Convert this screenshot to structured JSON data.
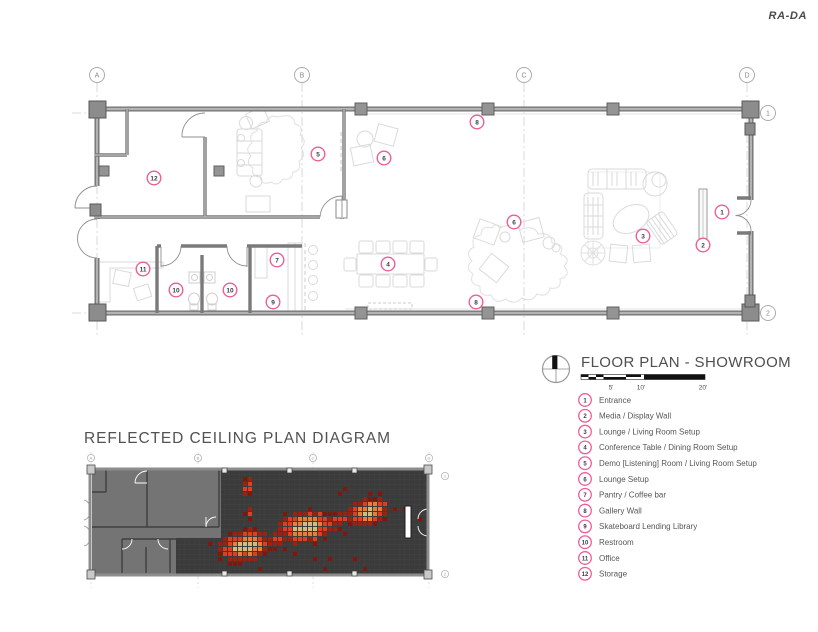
{
  "brand": {
    "logo": "RA-DA"
  },
  "floor_plan": {
    "title": "FLOOR PLAN - SHOWROOM",
    "scale_labels": [
      {
        "text": "5'",
        "x": 611
      },
      {
        "text": "10'",
        "x": 641
      },
      {
        "text": "20'",
        "x": 703
      }
    ],
    "grid_columns": [
      {
        "label": "A",
        "x": 97
      },
      {
        "label": "B",
        "x": 302
      },
      {
        "label": "C",
        "x": 524
      },
      {
        "label": "D",
        "x": 747
      }
    ],
    "grid_rows": [
      {
        "label": "1",
        "y": 113
      },
      {
        "label": "2",
        "y": 313
      }
    ],
    "markers": [
      {
        "num": "1",
        "x": 722,
        "y": 212
      },
      {
        "num": "2",
        "x": 703,
        "y": 245
      },
      {
        "num": "3",
        "x": 643,
        "y": 236
      },
      {
        "num": "4",
        "x": 388,
        "y": 264
      },
      {
        "num": "5",
        "x": 318,
        "y": 154
      },
      {
        "num": "6",
        "x": 384,
        "y": 158
      },
      {
        "num": "6",
        "x": 514,
        "y": 222
      },
      {
        "num": "7",
        "x": 277,
        "y": 260
      },
      {
        "num": "8",
        "x": 477,
        "y": 122
      },
      {
        "num": "8",
        "x": 476,
        "y": 302
      },
      {
        "num": "9",
        "x": 273,
        "y": 302
      },
      {
        "num": "10",
        "x": 176,
        "y": 290
      },
      {
        "num": "10",
        "x": 230,
        "y": 290
      },
      {
        "num": "11",
        "x": 143,
        "y": 269
      },
      {
        "num": "12",
        "x": 154,
        "y": 178
      }
    ],
    "legend": {
      "items": [
        {
          "num": "1",
          "label": "Entrance"
        },
        {
          "num": "2",
          "label": "Media / Display Wall"
        },
        {
          "num": "3",
          "label": "Lounge / Living Room Setup"
        },
        {
          "num": "4",
          "label": "Conference Table / Dining Room Setup"
        },
        {
          "num": "5",
          "label": "Demo [Listening] Room / Living Room Setup"
        },
        {
          "num": "6",
          "label": "Lounge Setup"
        },
        {
          "num": "7",
          "label": "Pantry / Coffee bar"
        },
        {
          "num": "8",
          "label": "Gallery Wall"
        },
        {
          "num": "9",
          "label": "Skateboard Lending Library"
        },
        {
          "num": "10",
          "label": "Restroom"
        },
        {
          "num": "11",
          "label": "Office"
        },
        {
          "num": "12",
          "label": "Storage"
        }
      ]
    },
    "marker_color": "#ee5e95"
  },
  "ceiling_plan": {
    "title": "REFLECTED CEILING PLAN DIAGRAM",
    "grid_columns": [
      {
        "label": "A",
        "x": 91
      },
      {
        "label": "B",
        "x": 198
      },
      {
        "label": "C",
        "x": 313
      },
      {
        "label": "D",
        "x": 429
      }
    ],
    "grid_rows": [
      {
        "label": "1",
        "x": 445,
        "y": 476
      },
      {
        "label": "2",
        "x": 445,
        "y": 574
      }
    ],
    "heatmap": {
      "cell": 4,
      "pitch": 5,
      "seed": 13,
      "x0": 178,
      "x1": 422,
      "y0": 472,
      "y1": 570,
      "step_y": 538,
      "min_x_above": 223,
      "min_x_below": 178,
      "colors": {
        "tan": "#d2bb7d",
        "orange": "#ee7c33",
        "red": "#e63c1e",
        "dark": "#9e2110",
        "maroon": "#7f170b"
      },
      "thresholds": {
        "tan": 0.82,
        "orange": 0.6,
        "red": 0.37,
        "dark": 0.21,
        "maroon": 0.11
      },
      "noise": 0.09,
      "blobs": [
        {
          "cx": 248,
          "cy": 487,
          "rx": 8,
          "ry": 14,
          "rot": 10,
          "peak": 0.62
        },
        {
          "cx": 250,
          "cy": 514,
          "rx": 6,
          "ry": 9,
          "rot": 0,
          "peak": 0.42
        },
        {
          "cx": 246,
          "cy": 546,
          "rx": 33,
          "ry": 18,
          "rot": -8,
          "peak": 1.0
        },
        {
          "cx": 306,
          "cy": 527,
          "rx": 36,
          "ry": 19,
          "rot": -10,
          "peak": 1.0
        },
        {
          "cx": 369,
          "cy": 512,
          "rx": 26,
          "ry": 16,
          "rot": -14,
          "peak": 0.95
        },
        {
          "cx": 276,
          "cy": 539,
          "rx": 13,
          "ry": 10,
          "rot": 0,
          "peak": 0.5
        },
        {
          "cx": 340,
          "cy": 520,
          "rx": 13,
          "ry": 10,
          "rot": 0,
          "peak": 0.48
        }
      ]
    }
  }
}
